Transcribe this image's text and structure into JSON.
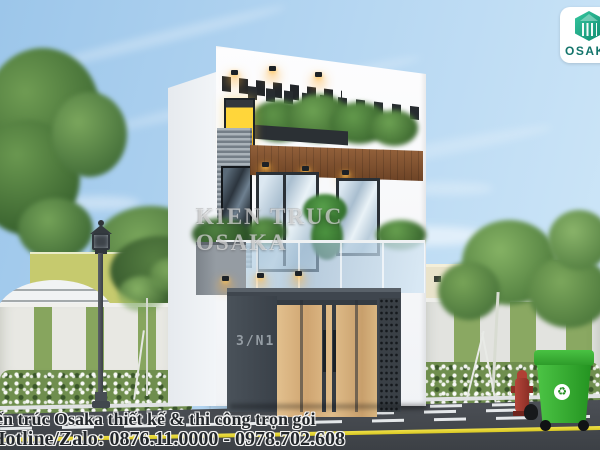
{
  "scene_type": "3D exterior architectural render, modern 3-storey townhouse",
  "branding": {
    "logo_text": "OSAKA",
    "logo_icon": "hexagon-buildings-logo",
    "logo_text_color": "#14746b",
    "logo_green": "#1aa385"
  },
  "watermark_center": "KIEN TRUC OSAKA",
  "caption": {
    "line1": "Kiến trúc Osaka thiết kế & thi công trọn gói",
    "line2": "Hotline/Zalo: 0876.11.0000 - 0978.702.608"
  },
  "house": {
    "number_plate": "3/N1",
    "storeys": 3
  },
  "icons": {
    "recycle": "♻"
  },
  "objects": [
    "street-lamp",
    "fire-hydrant",
    "recycle-bin",
    "garage-gate",
    "balcony",
    "rooftop-pergola",
    "hedge-fence",
    "sidewalk",
    "road"
  ],
  "palette": {
    "sky": "#aacfee",
    "facade_white": "#f5f7f9",
    "charcoal_gate": "#3f464e",
    "wood_door": "#d4ab77",
    "soffit_wood": "#7d4f2c",
    "foliage": "#5d8a46",
    "road": "#45494f",
    "lane_yellow": "#e6d62e",
    "bin_green": "#2fa12c",
    "hydrant_red": "#a63b2f",
    "window_glow": "#ffd63a"
  }
}
